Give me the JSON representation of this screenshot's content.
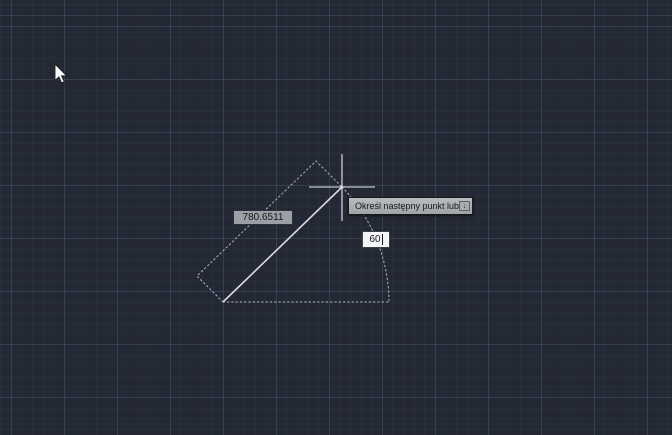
{
  "app": {
    "type": "cad-model-space",
    "command_state": "line-drawing-in-progress"
  },
  "dynamic_input": {
    "tooltip_text": "Określ następny punkt lub",
    "tooltip_icon": "down-arrow-key-icon",
    "tooltip_icon_glyph": "↓",
    "length_field": {
      "value": "780.6511"
    },
    "angle_field": {
      "value": "60"
    }
  },
  "cursor": {
    "pointer": "arrow-pointer",
    "drawing_cursor": "crosshair"
  },
  "colors": {
    "background": "#232834",
    "grid_major": "#2e3543",
    "grid_minor": "#272d3a",
    "rubber_band_line": "#d9dbde",
    "crosshair": "#e9ebee",
    "dotted_preview": "#b1b7be",
    "tooltip_background": "#aeb2b5",
    "tooltip_text": "#15181c",
    "length_field_background": "#9aa0a5",
    "angle_field_background": "#f4f5f6",
    "field_text": "#14171a",
    "pointer_fill": "#ffffff",
    "pointer_outline": "#1c1f24"
  }
}
